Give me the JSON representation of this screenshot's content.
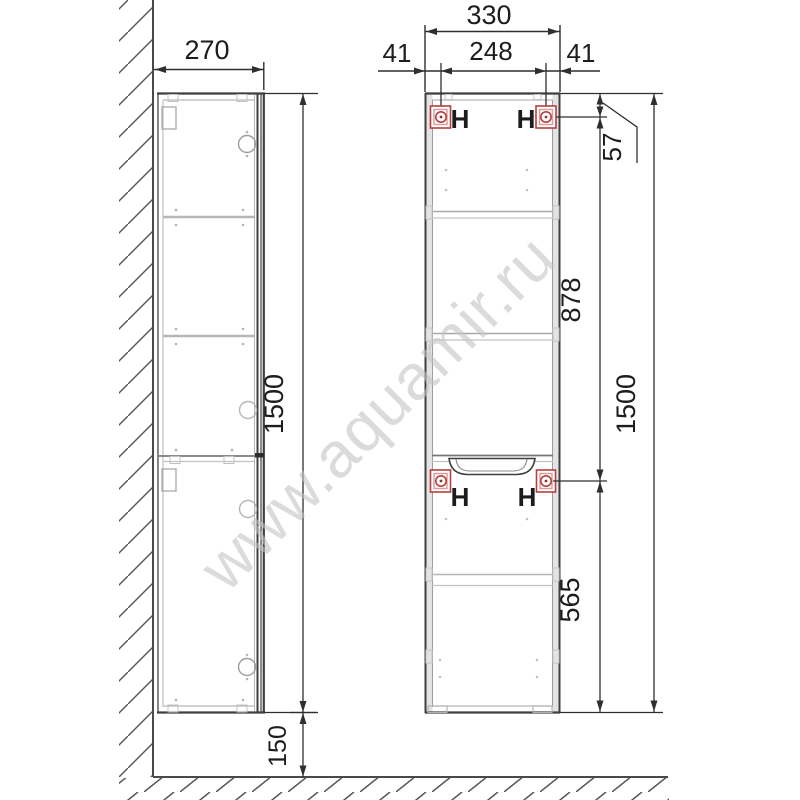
{
  "watermark": {
    "text": "www.aquamir.ru"
  },
  "colors": {
    "main_line": "#3f3f3f",
    "dim_line": "#2f2f2f",
    "light_line": "#b6b6ba",
    "mount_red": "#b5403e",
    "mount_red_light": "#dd9a9a",
    "watermark_gray": "#c4c4c4"
  },
  "side_view": {
    "depth_mm": "270",
    "height_mm": "1500",
    "floor_clearance_mm": "150"
  },
  "front_view": {
    "width_mm": "330",
    "hanger_span_mm": "248",
    "hanger_offset_left_mm": "41",
    "hanger_offset_right_mm": "41",
    "top_to_hanger_mm": "57",
    "upper_section_mm": "878",
    "height_mm": "1500",
    "lower_section_mm": "565",
    "hanger_labels": [
      "H",
      "H",
      "H",
      "H"
    ]
  }
}
